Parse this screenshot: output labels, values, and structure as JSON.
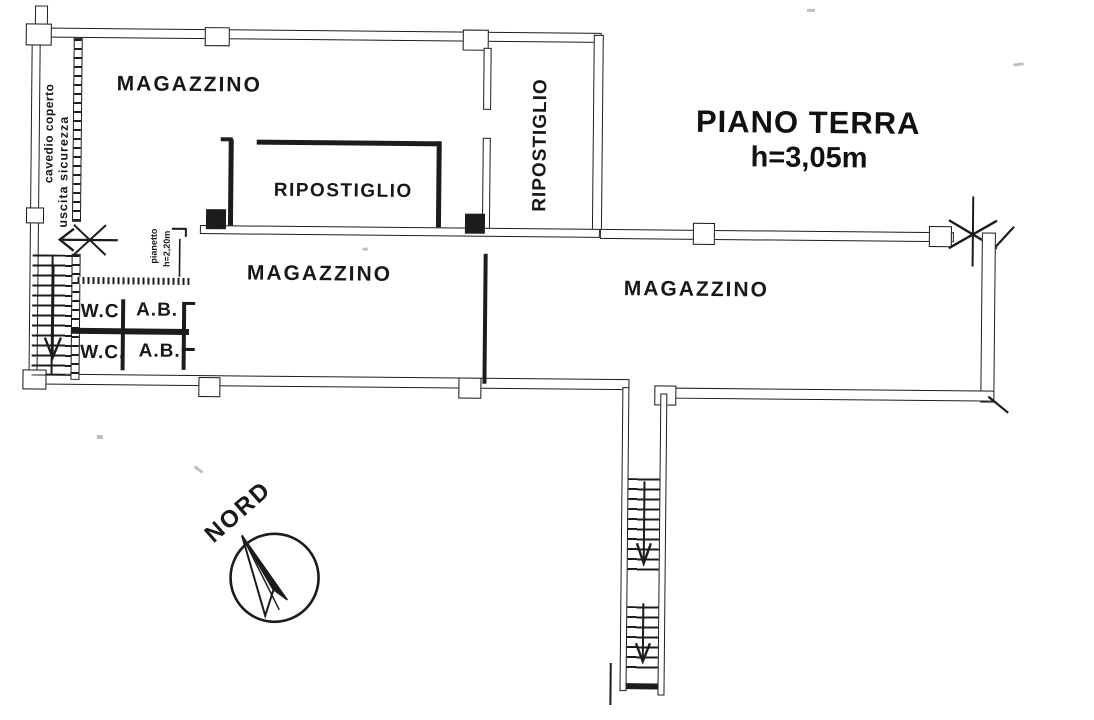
{
  "title": {
    "text": "PIANO TERRA",
    "height": "h=3,05m"
  },
  "rooms": {
    "magazzino_upper": "MAGAZZINO",
    "ripostiglio_inner": "RIPOSTIGLIO",
    "ripostiglio_vertical": "RIPOSTIGLIO",
    "magazzino_center": "MAGAZZINO",
    "magazzino_right": "MAGAZZINO",
    "wc_upper": "W.C",
    "ab_upper": "A.B.",
    "wc_lower": "W.C.",
    "ab_lower": "A.B."
  },
  "annotations": {
    "cavedio": "cavedio coperto",
    "uscita": "uscita sicurezza",
    "pianetto_line1": "pianetto",
    "pianetto_line2": "h=2,20m",
    "compass": "NORD"
  },
  "colors": {
    "ink": "#1c1c1c",
    "paper": "#ffffff"
  }
}
